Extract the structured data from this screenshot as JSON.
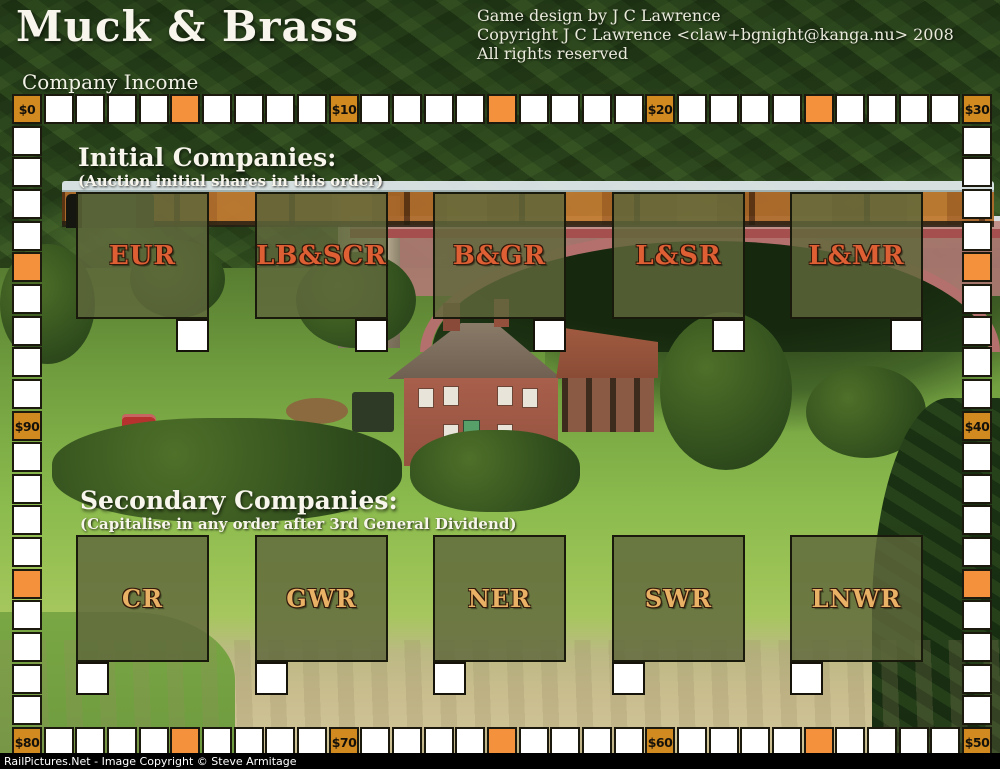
{
  "header": {
    "title": "Muck & Brass",
    "credit_lines": [
      "Game design by J C Lawrence",
      "Copyright J C Lawrence <claw+bgnight@kanga.nu> 2008",
      "All rights reserved"
    ]
  },
  "income_track": {
    "label": "Company Income",
    "cell_count": 100,
    "milestones": [
      {
        "value": 0,
        "text": "$0"
      },
      {
        "value": 10,
        "text": "$10"
      },
      {
        "value": 20,
        "text": "$20"
      },
      {
        "value": 30,
        "text": "$30"
      },
      {
        "value": 40,
        "text": "$40"
      },
      {
        "value": 50,
        "text": "$50"
      },
      {
        "value": 60,
        "text": "$60"
      },
      {
        "value": 70,
        "text": "$70"
      },
      {
        "value": 80,
        "text": "$80"
      },
      {
        "value": 90,
        "text": "$90"
      }
    ],
    "highlight_values": [
      5,
      15,
      25,
      35,
      45,
      55,
      65,
      75,
      85,
      95
    ],
    "colors": {
      "milestone_fill": "#d18a20",
      "highlight_fill": "#f4913c",
      "cell_fill": "#ffffff",
      "cell_border": "#1c190e"
    }
  },
  "initial_companies": {
    "heading": "Initial Companies:",
    "subheading": "(Auction initial shares in this order)",
    "name_color": "#dd5f33",
    "companies": [
      {
        "name": "EUR"
      },
      {
        "name": "LB&SCR"
      },
      {
        "name": "B&GR"
      },
      {
        "name": "L&SR"
      },
      {
        "name": "L&MR"
      }
    ]
  },
  "secondary_companies": {
    "heading": "Secondary Companies:",
    "subheading": "(Capitalise in any order after 3rd General Dividend)",
    "name_color": "#e9b165",
    "companies": [
      {
        "name": "CR"
      },
      {
        "name": "GWR"
      },
      {
        "name": "NER"
      },
      {
        "name": "SWR"
      },
      {
        "name": "LNWR"
      }
    ]
  },
  "watermark": {
    "text": "RailPictures.Net - Image Copyright © Steve Armitage"
  }
}
